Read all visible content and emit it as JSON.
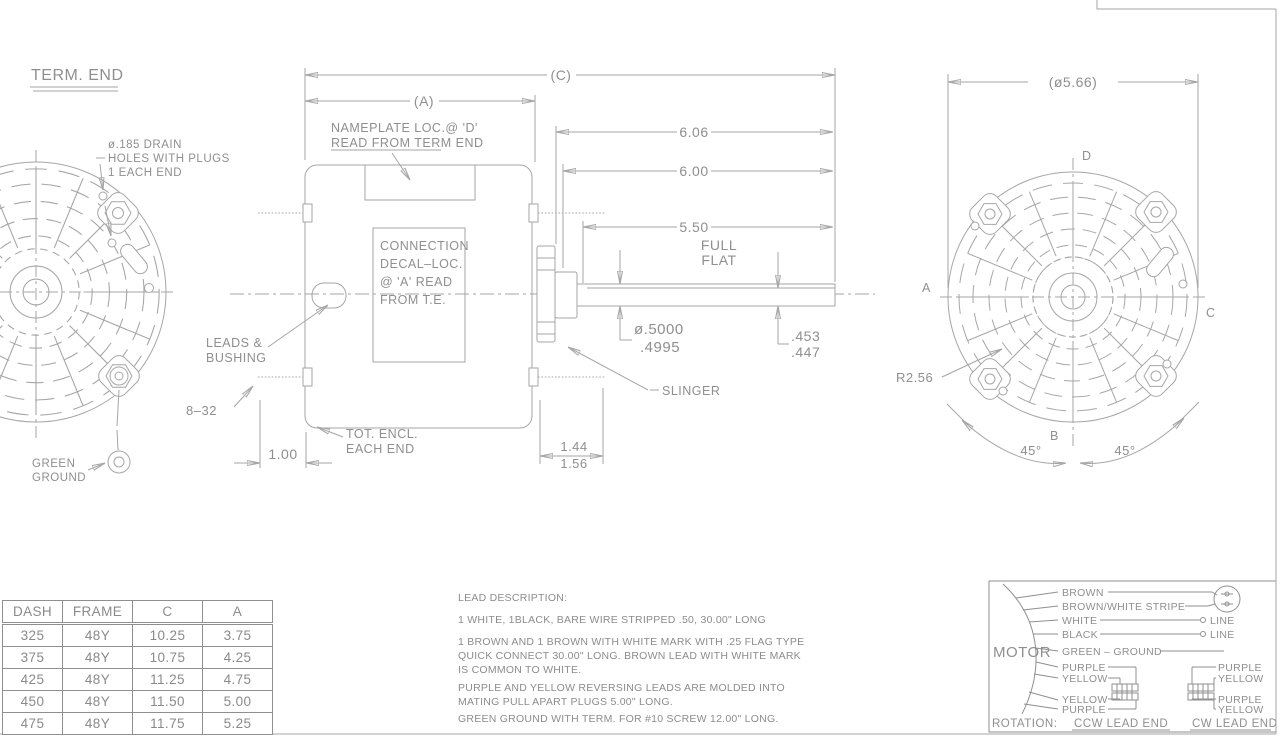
{
  "palette": {
    "line": "#a6a6a6",
    "dark_line": "#8f8f8f",
    "text": "#8f8f8f",
    "background": "#ffffff"
  },
  "left_view": {
    "title": "TERM. END",
    "drain_note_1": "ø.185 DRAIN",
    "drain_note_2": "HOLES WITH PLUGS",
    "drain_note_3": "1 EACH END",
    "ground_label_1": "GREEN",
    "ground_label_2": "GROUND"
  },
  "side_view": {
    "dim_c": "(C)",
    "dim_a": "(A)",
    "nameplate_note_1": "NAMEPLATE LOC.@ 'D'",
    "nameplate_note_2": "READ FROM TERM END",
    "decal_note_1": "CONNECTION",
    "decal_note_2": "DECAL–LOC.",
    "decal_note_3": "@ 'A' READ",
    "decal_note_4": "FROM T.E.",
    "leads_note_1": "LEADS &",
    "leads_note_2": "BUSHING",
    "thread_callout": "8–32",
    "stud_dim": "1.00",
    "encl_note_1": "TOT. ENCL.",
    "encl_note_2": "EACH END",
    "dim_606": "6.06",
    "dim_600": "6.00",
    "dim_550": "5.50",
    "full": "FULL",
    "flat": "FLAT",
    "shaft_dia_1": "ø.5000",
    "shaft_dia_2": ".4995",
    "flat_dim_1": ".453",
    "flat_dim_2": ".447",
    "hub_dim_1": "1.44",
    "hub_dim_2": "1.56",
    "slinger_label": "SLINGER"
  },
  "end_view": {
    "dia": "(ø5.66)",
    "label_a": "A",
    "label_b": "B",
    "label_c": "C",
    "label_d": "D",
    "radius": "R2.56",
    "angle_left": "45°",
    "angle_right": "45°"
  },
  "table": {
    "headers": [
      "DASH",
      "FRAME",
      "C",
      "A"
    ],
    "rows": [
      [
        "325",
        "48Y",
        "10.25",
        "3.75"
      ],
      [
        "375",
        "48Y",
        "10.75",
        "4.25"
      ],
      [
        "425",
        "48Y",
        "11.25",
        "4.75"
      ],
      [
        "450",
        "48Y",
        "11.50",
        "5.00"
      ],
      [
        "475",
        "48Y",
        "11.75",
        "5.25"
      ]
    ]
  },
  "leads": {
    "title": "LEAD DESCRIPTION:",
    "p1": "1 WHITE, 1BLACK, BARE WIRE STRIPPED .50, 30.00\" LONG",
    "p2": "1 BROWN AND 1 BROWN WITH WHITE MARK WITH .25 FLAG TYPE QUICK CONNECT 30.00\" LONG.  BROWN LEAD WITH WHITE MARK IS COMMON TO WHITE.",
    "p3": "PURPLE AND YELLOW REVERSING LEADS ARE MOLDED INTO MATING PULL APART PLUGS 5.00\" LONG.",
    "p4": "GREEN GROUND WITH TERM. FOR #10 SCREW 12.00\" LONG."
  },
  "wiring": {
    "motor": "MOTOR",
    "brown": "BROWN",
    "brown_white": "BROWN/WHITE STRIPE",
    "white": "WHITE",
    "black": "BLACK",
    "green": "GREEN – GROUND",
    "purple_top": "PURPLE",
    "yellow_top": "YELLOW",
    "yellow_bot": "YELLOW",
    "purple_bot": "PURPLE",
    "r_purple_top": "PURPLE",
    "r_yellow_top": "YELLOW",
    "r_purple_bot": "PURPLE",
    "r_yellow_bot": "YELLOW",
    "line1": "LINE",
    "line2": "LINE",
    "rotation": "ROTATION:",
    "ccw": "CCW LEAD END",
    "cw": "CW LEAD END"
  }
}
